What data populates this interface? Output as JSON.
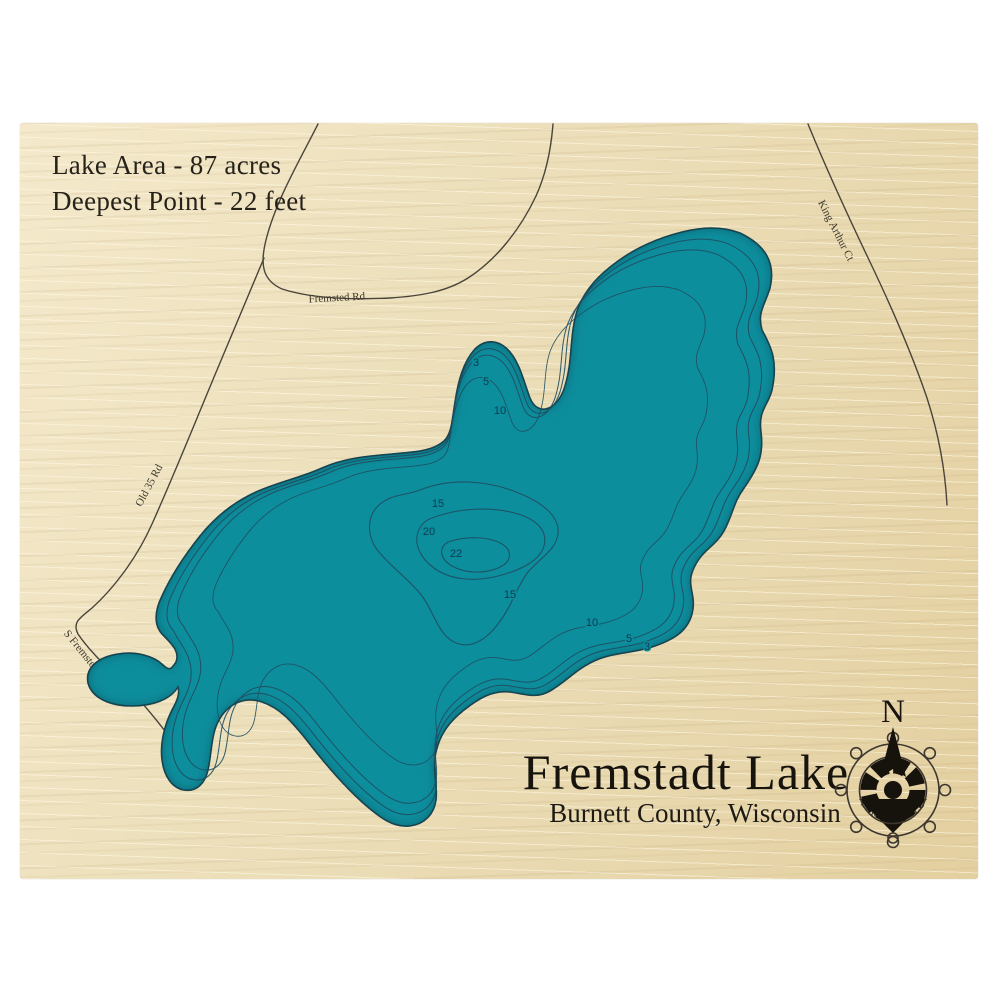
{
  "board": {
    "stats": [
      "Lake Area - 87 acres",
      "Deepest Point - 22 feet"
    ],
    "title": "Fremstadt Lake",
    "subtitle": "Burnett County, Wisconsin",
    "roads": {
      "fremsted": "Fremsted Rd",
      "king_arthur": "King Arthur Ct",
      "old_35": "Old 35 Rd",
      "s_fremsted": "S Fremsted Rd"
    },
    "depths": [
      "3",
      "5",
      "10",
      "15",
      "20",
      "22",
      "15",
      "10",
      "5",
      "3"
    ],
    "compass": {
      "north": "N",
      "brand": "LAKE ART LLC"
    },
    "colors": {
      "water": "#0a8e9d",
      "water_shadow": "#04404d",
      "wood": "#ecdfbc",
      "contour": "#1f4d60",
      "road": "#4a453a",
      "ink": "#26221a"
    }
  }
}
